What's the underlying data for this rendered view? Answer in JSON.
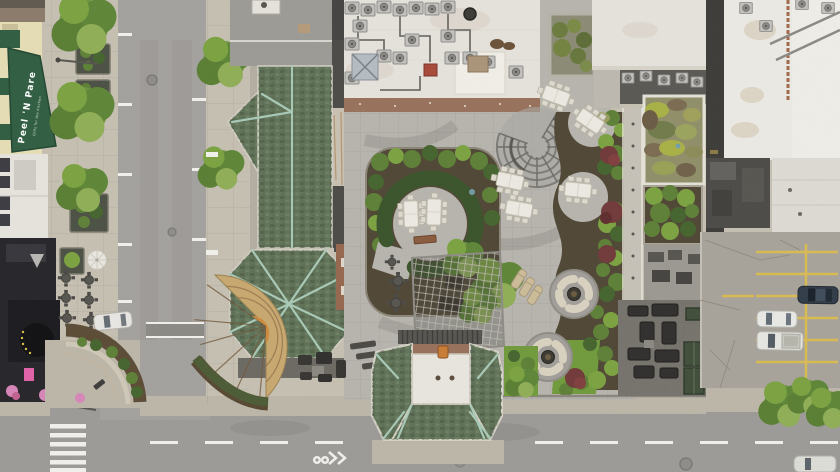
{
  "meta": {
    "title": "Aerial drone photo, top-down view of a city block with a landscaped rooftop terrace",
    "view": "orthographic top-down"
  },
  "signs": {
    "awning_primary": "Peel 'N Pare",
    "awning_secondary": "Gifts for the Kitchen"
  },
  "palette": {
    "asphalt": "#a3a19e",
    "asphalt2": "#9c9a97",
    "sidewalk": "#c6c0b2",
    "sidewalk2": "#bcb6a8",
    "roofGreen": "#5f7257",
    "roofRidge": "#a8c9b6",
    "terrace": "#b7b4ae",
    "whiteRoof": "#e6e3dc",
    "darkRoof": "#4a4946",
    "mulch": "#4e4533",
    "hedge": "#3f5a2e",
    "bushBright": "#7aa23f",
    "bushMid": "#5c7f35",
    "bushDark": "#43632c",
    "awning": "#2e5c40",
    "parkingYellow": "#d9bb4f",
    "roadWhite": "#f2f1ec",
    "brick": "#97705a",
    "parkingLot": "#a7a29a",
    "maroonTree": "#713838",
    "creamSofa": "#d9d2c0",
    "storefrontYellow": "#e6deb4",
    "pinkSign": "#e060a8"
  },
  "scene": {
    "rooftop_terrace": {
      "dining_tables": 7,
      "fire_pit_lounges": 2,
      "chaise_lounges": 3,
      "horseshoe_hedge_garden": 1,
      "spiral_pergola": 1,
      "lattice_pergola": 1
    },
    "streets": {
      "vertical_street_left": true,
      "horizontal_street_bottom": true,
      "crosswalk_bars": 6,
      "bike_sharrow": true
    },
    "vehicles": [
      {
        "type": "parked-car",
        "color": "white",
        "location": "left street"
      },
      {
        "type": "suv",
        "color": "dark-blue",
        "location": "parking lot"
      },
      {
        "type": "sedan",
        "color": "white",
        "location": "parking lot"
      },
      {
        "type": "pickup-truck",
        "color": "white",
        "location": "parking lot"
      },
      {
        "type": "car",
        "color": "white",
        "location": "bottom street edge"
      }
    ],
    "roofs": [
      "copper-patina hip roofs",
      "white HVAC roof",
      "sedum green roof",
      "dark flat roofs"
    ]
  }
}
